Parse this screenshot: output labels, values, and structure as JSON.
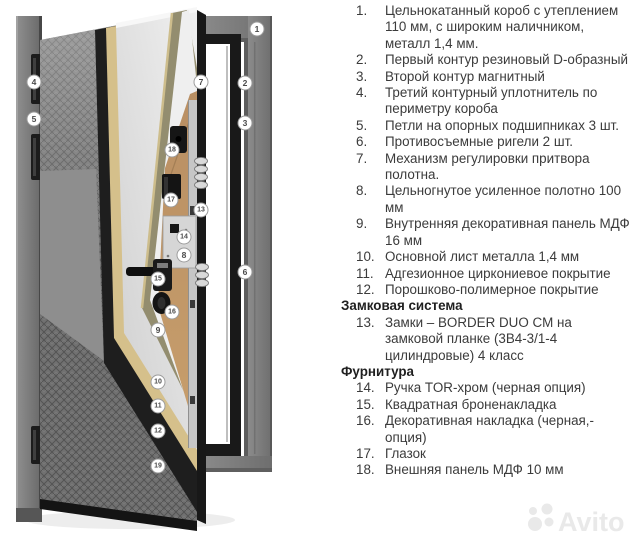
{
  "list": {
    "sections": [
      {
        "heading": null,
        "items": [
          {
            "num": "1.",
            "text": "Цельнокатанный короб с утеплением 110 мм, с широким наличником, металл 1,4 мм."
          },
          {
            "num": "2.",
            "text": "Первый контур резиновый D-образный"
          },
          {
            "num": "3.",
            "text": "Второй контур магнитный"
          },
          {
            "num": "4.",
            "text": "Третий контурный уплотнитель по периметру короба"
          },
          {
            "num": "5.",
            "text": "Петли на опорных подшипниках 3 шт."
          },
          {
            "num": "6.",
            "text": "Противосъемные ригели 2 шт."
          },
          {
            "num": "7.",
            "text": "Механизм регулировки притвора полотна."
          },
          {
            "num": "8.",
            "text": "Цельногнутое усиленное полотно 100 мм"
          },
          {
            "num": "9.",
            "text": "Внутренняя декоративная панель МДФ 16 мм"
          },
          {
            "num": "10.",
            "text": "Основной лист металла 1,4 мм"
          },
          {
            "num": "11.",
            "text": "Адгезионное циркониевое покрытие"
          },
          {
            "num": "12.",
            "text": "Порошково-полимерное покрытие"
          }
        ]
      },
      {
        "heading": "Замковая система",
        "items": [
          {
            "num": "13.",
            "text": "Замки – BORDER DUO CM на замковой планке (3В4-3/1-4 цилиндровые) 4 класс"
          }
        ]
      },
      {
        "heading": "Фурнитура",
        "items": [
          {
            "num": "14.",
            "text": "Ручка TOR-хром (черная опция)"
          },
          {
            "num": "15.",
            "text": "Квадратная броненакладка"
          },
          {
            "num": "16.",
            "text": "Декоративная накладка (черная,- опция)"
          },
          {
            "num": "17.",
            "text": "Глазок"
          },
          {
            "num": "18.",
            "text": "Внешняя панель МДФ 10 мм"
          }
        ]
      }
    ]
  },
  "diagram": {
    "markers": [
      {
        "n": "1",
        "x": 257,
        "y": 29
      },
      {
        "n": "2",
        "x": 245,
        "y": 83
      },
      {
        "n": "3",
        "x": 245,
        "y": 123
      },
      {
        "n": "4",
        "x": 34,
        "y": 82
      },
      {
        "n": "5",
        "x": 34,
        "y": 119
      },
      {
        "n": "6",
        "x": 245,
        "y": 272
      },
      {
        "n": "7",
        "x": 201,
        "y": 82
      },
      {
        "n": "8",
        "x": 184,
        "y": 255
      },
      {
        "n": "9",
        "x": 158,
        "y": 330
      },
      {
        "n": "10",
        "x": 158,
        "y": 382
      },
      {
        "n": "11",
        "x": 158,
        "y": 406
      },
      {
        "n": "12",
        "x": 158,
        "y": 431
      },
      {
        "n": "13",
        "x": 201,
        "y": 210
      },
      {
        "n": "14",
        "x": 184,
        "y": 237
      },
      {
        "n": "15",
        "x": 158,
        "y": 279
      },
      {
        "n": "16",
        "x": 172,
        "y": 312
      },
      {
        "n": "17",
        "x": 171,
        "y": 200
      },
      {
        "n": "18",
        "x": 172,
        "y": 150
      },
      {
        "n": "19",
        "x": 158,
        "y": 466
      }
    ],
    "colors": {
      "text": "#3b3b3b",
      "frame": "#7b7b7b",
      "leafblack": "#1e1e1e",
      "beige": "#d5c08b",
      "metalwhite": "#e7e7e7",
      "olive": "#938d6f",
      "wood": "#b98f63",
      "markerstroke": "#9c9c9c",
      "watermarkgray": "#e9e9e9"
    }
  },
  "watermark": {
    "text": "Avito"
  }
}
